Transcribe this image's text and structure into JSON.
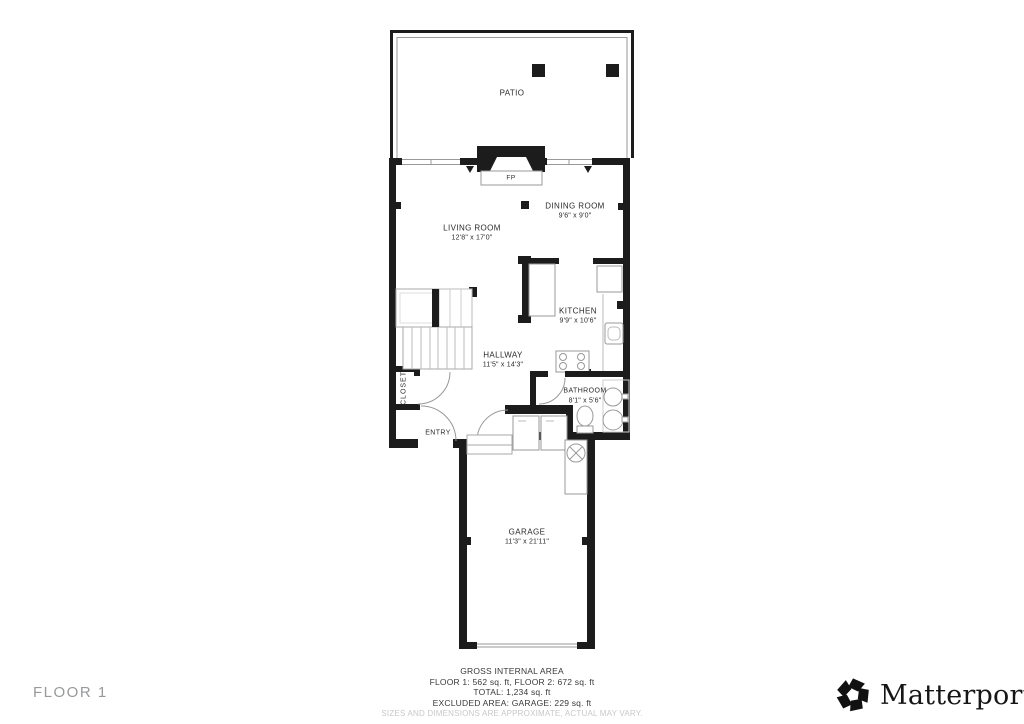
{
  "floor": {
    "label": "FLOOR 1"
  },
  "rooms": {
    "patio": {
      "name": "PATIO"
    },
    "living_room": {
      "name": "LIVING ROOM",
      "dims": "12'8\" x 17'0\""
    },
    "dining_room": {
      "name": "DINING ROOM",
      "dims": "9'6\" x 9'0\""
    },
    "kitchen": {
      "name": "KITCHEN",
      "dims": "9'9\" x 10'6\""
    },
    "hallway": {
      "name": "HALLWAY",
      "dims": "11'5\" x 14'3\""
    },
    "closet": {
      "name": "CLOSET"
    },
    "entry": {
      "name": "ENTRY"
    },
    "bathroom": {
      "name": "BATHROOM",
      "dims": "8'1\" x 5'6\""
    },
    "garage": {
      "name": "GARAGE",
      "dims": "11'3\" x 21'11\""
    },
    "fireplace": {
      "label": "FP"
    }
  },
  "area_summary": {
    "title": "GROSS INTERNAL AREA",
    "floors": "FLOOR 1: 562 sq. ft, FLOOR 2: 672 sq. ft",
    "total": "TOTAL: 1,234 sq. ft",
    "excluded": "EXCLUDED AREA: GARAGE: 229 sq. ft",
    "disclaimer": "SIZES AND DIMENSIONS ARE APPROXIMATE, ACTUAL MAY VARY."
  },
  "branding": {
    "name": "Matterport",
    "registered_mark": "®"
  },
  "colors": {
    "wall": "#1c1c1c",
    "fixture": "#999999",
    "muted": "#97999b",
    "disclaimer": "#c8c8c8"
  }
}
